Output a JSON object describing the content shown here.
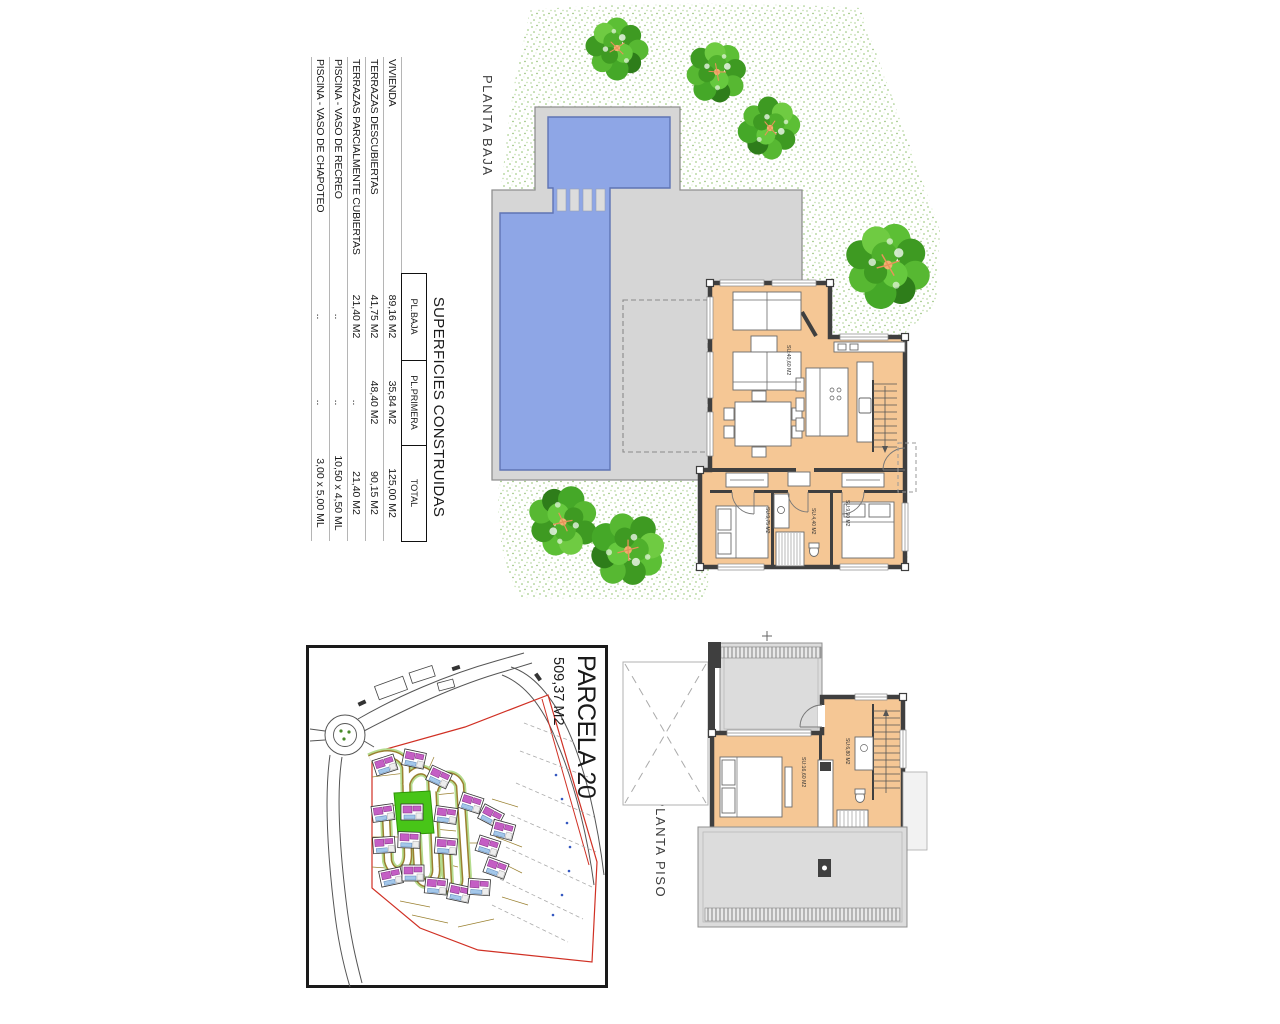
{
  "table": {
    "title": "SUPERFICIES CONSTRUIDAS",
    "columns": [
      "PL.BAJA",
      "PL.PRIMERA",
      "TOTAL"
    ],
    "rows": [
      {
        "label": "VIVIENDA",
        "cells": [
          "89,16 M2",
          "35,84 M2",
          "125,00 M2"
        ]
      },
      {
        "label": "TERRAZAS DESCUBIERTAS",
        "cells": [
          "41,75 M2",
          "48,40 M2",
          "90,15 M2"
        ]
      },
      {
        "label": "TERRAZAS PARCIALMENTE CUBIERTAS",
        "cells": [
          "21,40 M2",
          "..",
          "21,40 M2"
        ]
      },
      {
        "label": "PISCINA - VASO DE RECREO",
        "cells": [
          "..",
          "..",
          "10,50 x 4,50 ML"
        ]
      },
      {
        "label": "PISCINA - VASO DE CHAPOTEO",
        "cells": [
          "..",
          "..",
          "3,00 x 5,00 ML"
        ]
      }
    ]
  },
  "plans": {
    "ground": {
      "label": "PLANTA BAJA",
      "living": "SU:40,60 M2",
      "bedroom_left": "SU:9,75 M2",
      "bathroom": "SU:4,40 M2",
      "bedroom_right": "SU:9,90 M2"
    },
    "upper": {
      "label": "PLANTA PISO",
      "bedroom": "SU:16,60 M2",
      "bathroom": "SU:6,80 M2"
    }
  },
  "site_plan": {
    "parcel": "PARCELA 20",
    "area": "509,37 M2"
  },
  "colors": {
    "pool": "#8EA6E6",
    "room_fill": "#F5C795",
    "deck": "#D6D6D6",
    "wall": "#3F3F3F",
    "tree_green": "#4FB02C",
    "parcel_highlight": "#48C518",
    "boundary_red": "#D03024"
  }
}
